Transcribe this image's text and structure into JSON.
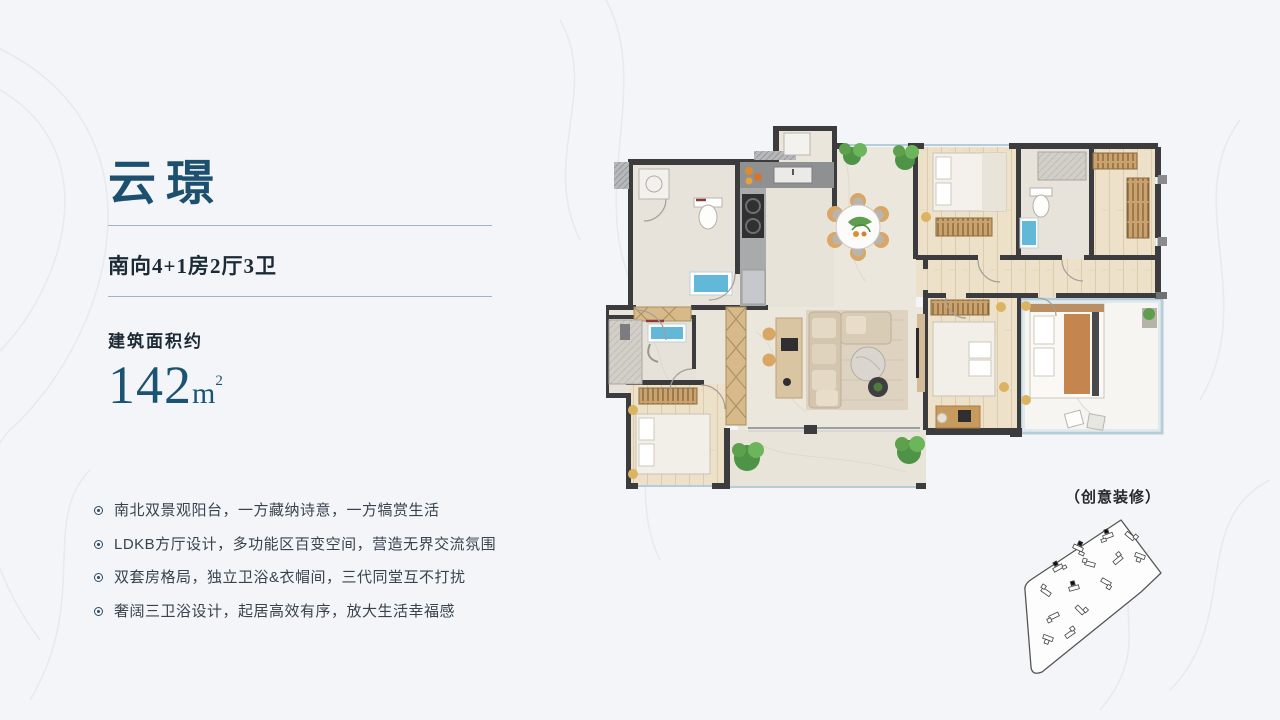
{
  "slide": {
    "background": "#f3f5f8",
    "accent_color": "#1d4f6e",
    "title": "云璟",
    "subtitle": "南向4+1房2厅3卫",
    "area": {
      "label": "建筑面积约",
      "value": "142",
      "unit": "m",
      "exponent": "2"
    },
    "features": [
      "南北双景观阳台，一方藏纳诗意，一方犒赏生活",
      "LDKB方厅设计，多功能区百变空间，营造无界交流氛围",
      "双套房格局，独立卫浴&衣帽间，三代同堂互不打扰",
      "奢阔三卫浴设计，起居高效有序，放大生活幸福感"
    ],
    "floorplan": {
      "caption": "（创意装修）"
    }
  }
}
